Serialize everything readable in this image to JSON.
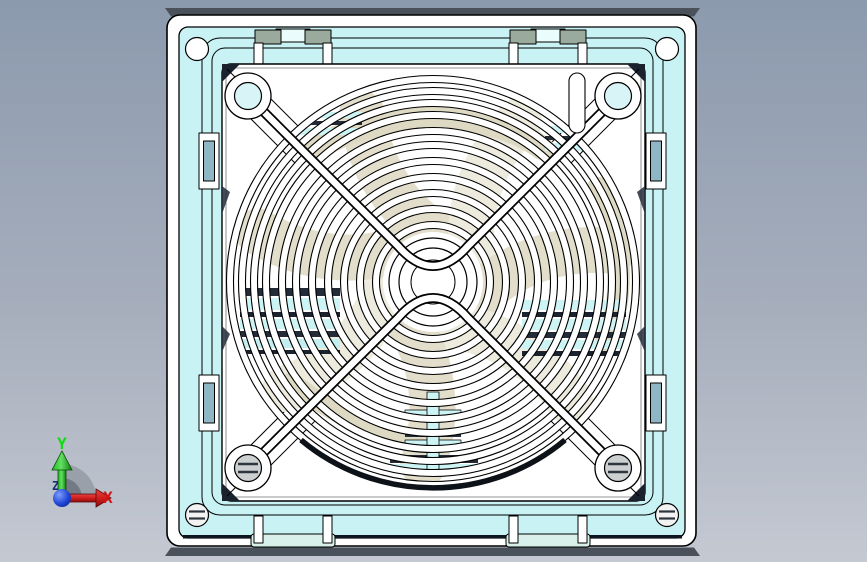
{
  "viewport": {
    "name": "cad-3d-viewport",
    "background_top": "#8c9aae",
    "background_bottom": "#c4c9d2"
  },
  "model": {
    "name": "axial-fan-with-finger-guard",
    "view": "front orthographic view of square axial fan assembly with wire grille, corner screws, mounting clips and snap tabs",
    "palette": {
      "outline": "#000000",
      "frame_cyan": "#c9f2f5",
      "panel_white": "#ffffff",
      "blade_beige": "#e2decb",
      "blade_beige_alt": "#edebdd",
      "stripe_cyan": "#cdf4f4",
      "stripe_dark": "#252c39",
      "clip_green": "#9aab9e",
      "clip_blue": "#8fb6c4",
      "edge_strip": "#4a515a"
    }
  },
  "triad": {
    "name": "orientation-triad",
    "y_label": "Y",
    "x_label": "X",
    "z_label": "Z",
    "y_color": "#0ddd0d",
    "x_color": "#d41414",
    "z_color": "#1a3178",
    "origin_color": "#1537c0",
    "arc_color": "#9aa0a9"
  }
}
